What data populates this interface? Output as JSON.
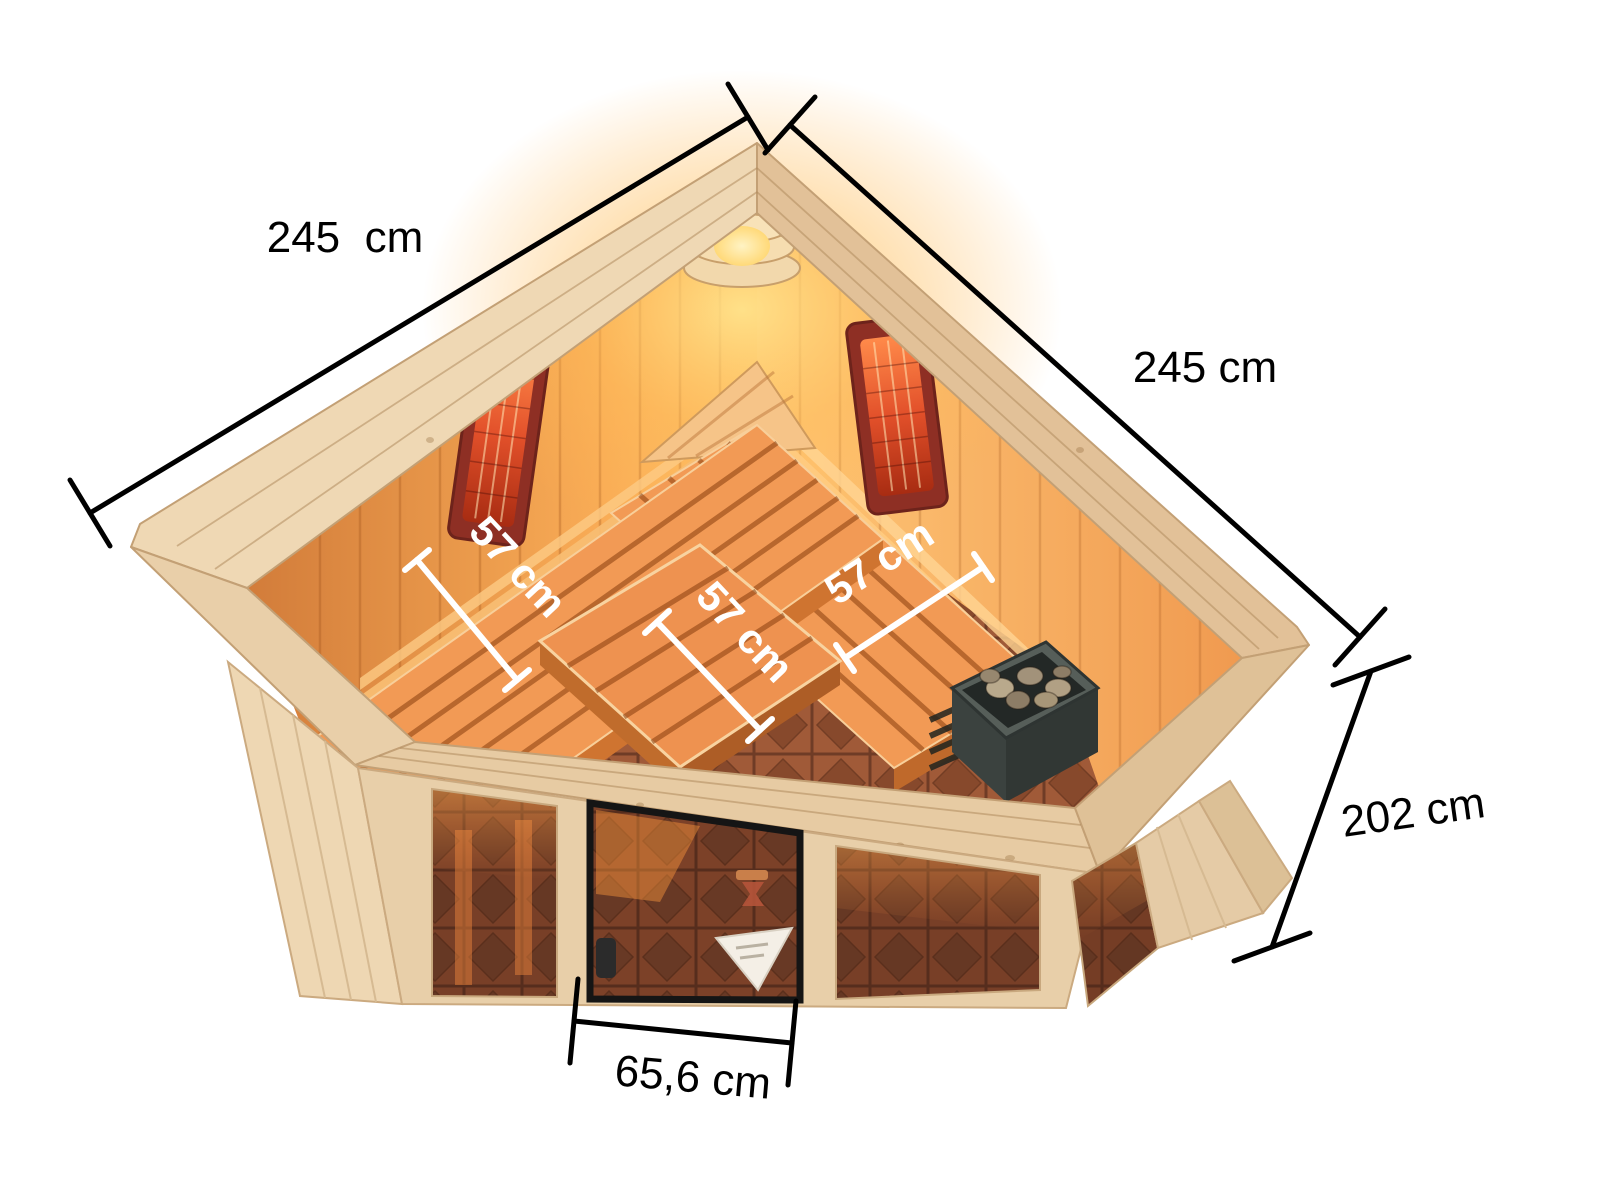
{
  "figure": {
    "kind": "corner sauna dimension diagram",
    "view": "isometric cutaway from above",
    "background": "#ffffff"
  },
  "annotations": {
    "width_left": {
      "label": "245  cm",
      "value_cm": 245
    },
    "width_right": {
      "label": "245 cm",
      "value_cm": 245
    },
    "height_right": {
      "label": "202 cm",
      "value_cm": 202
    },
    "door_width": {
      "label": "65,6 cm",
      "value_cm": 65.6
    },
    "bench_left": {
      "label": "57 cm",
      "value_cm": 57
    },
    "bench_middle": {
      "label": "57 cm",
      "value_cm": 57
    },
    "bench_right": {
      "label": "57 cm",
      "value_cm": 57
    }
  },
  "colors": {
    "background": "#ffffff",
    "dimension_line": "#000000",
    "interior_dimension_line": "#ffffff",
    "crown_wood": "#e7cba3",
    "exterior_wood": "#ecd3ad",
    "interior_wall_lit": "#ffc26a",
    "interior_wall_shaded": "#d27c3a",
    "bench_wood": "#f29a55",
    "glass_tile": "#8d4a2e",
    "infrared_panel": "#8e2f24",
    "heater_body": "#49514d",
    "lamp_glow": "#ffd98e"
  }
}
